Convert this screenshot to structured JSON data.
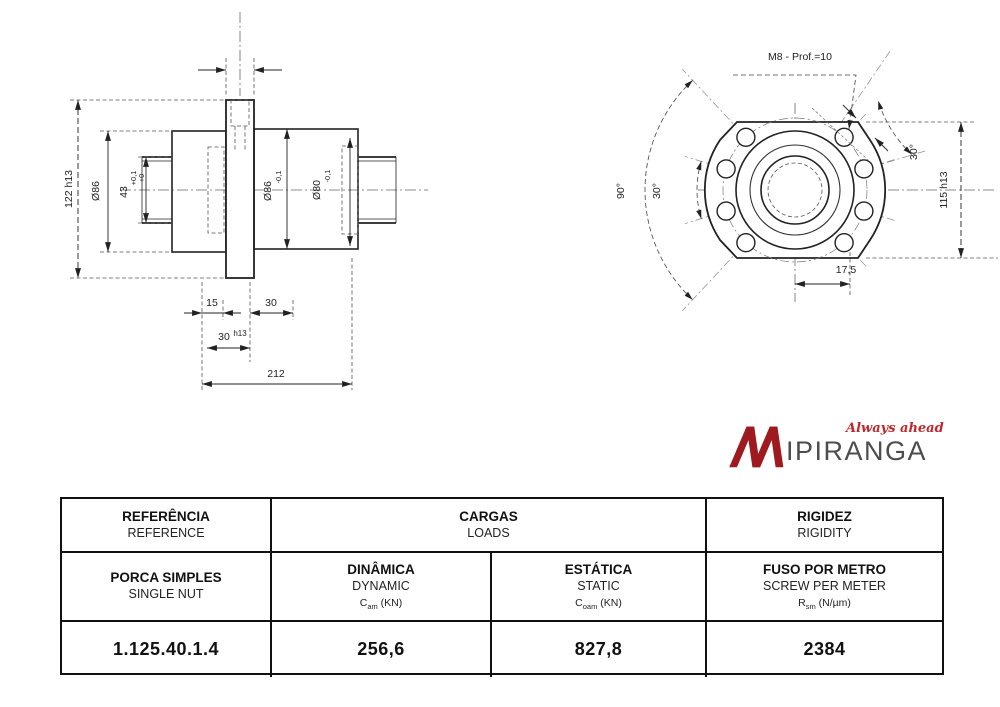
{
  "drawing": {
    "side_view": {
      "dim_flange_height": "122 h13",
      "dim_left_od": "Ø86",
      "dim_bore": "43",
      "dim_bore_tol_upper": "+0,1",
      "dim_bore_tol_lower": "+0",
      "dim_body_od": "Ø86",
      "dim_body_od_tol": "-0,1",
      "dim_spigot_od": "Ø80",
      "dim_spigot_tol": "-0,1",
      "dim_offset": "15",
      "dim_gap": "30",
      "dim_flange_thickness": "30",
      "dim_flange_thickness_tol": "h13",
      "dim_total_length": "212"
    },
    "front_view": {
      "thread_note": "M8 - Prof.=10",
      "angle_outer": "90°",
      "angle_inner": "30°",
      "angle_right": "30°",
      "dim_across_flats": "115 h13",
      "dim_hole_offset": "17,5"
    }
  },
  "logo": {
    "brand": "IPIRANGA",
    "tagline": "Always ahead",
    "brand_color": "#9e1a1f"
  },
  "table": {
    "header": {
      "ref_pt": "REFERÊNCIA",
      "ref_en": "REFERENCE",
      "loads_pt": "CARGAS",
      "loads_en": "LOADS",
      "rigidity_pt": "RIGIDEZ",
      "rigidity_en": "RIGIDITY"
    },
    "sub": {
      "product_pt": "PORCA SIMPLES",
      "product_en": "SINGLE NUT",
      "dynamic_pt": "DINÂMICA",
      "dynamic_en": "DYNAMIC",
      "dynamic_sym": "C",
      "dynamic_sub": "am",
      "dynamic_unit": "(KN)",
      "static_pt": "ESTÁTICA",
      "static_en": "STATIC",
      "static_sym": "C",
      "static_sub": "oam",
      "static_unit": "(KN)",
      "stiff_pt": "FUSO POR METRO",
      "stiff_en": "SCREW PER METER",
      "stiff_sym": "R",
      "stiff_sub": "sm",
      "stiff_unit": "(N/µm)"
    },
    "values": {
      "reference": "1.125.40.1.4",
      "dynamic": "256,6",
      "static": "827,8",
      "stiffness": "2384"
    }
  }
}
